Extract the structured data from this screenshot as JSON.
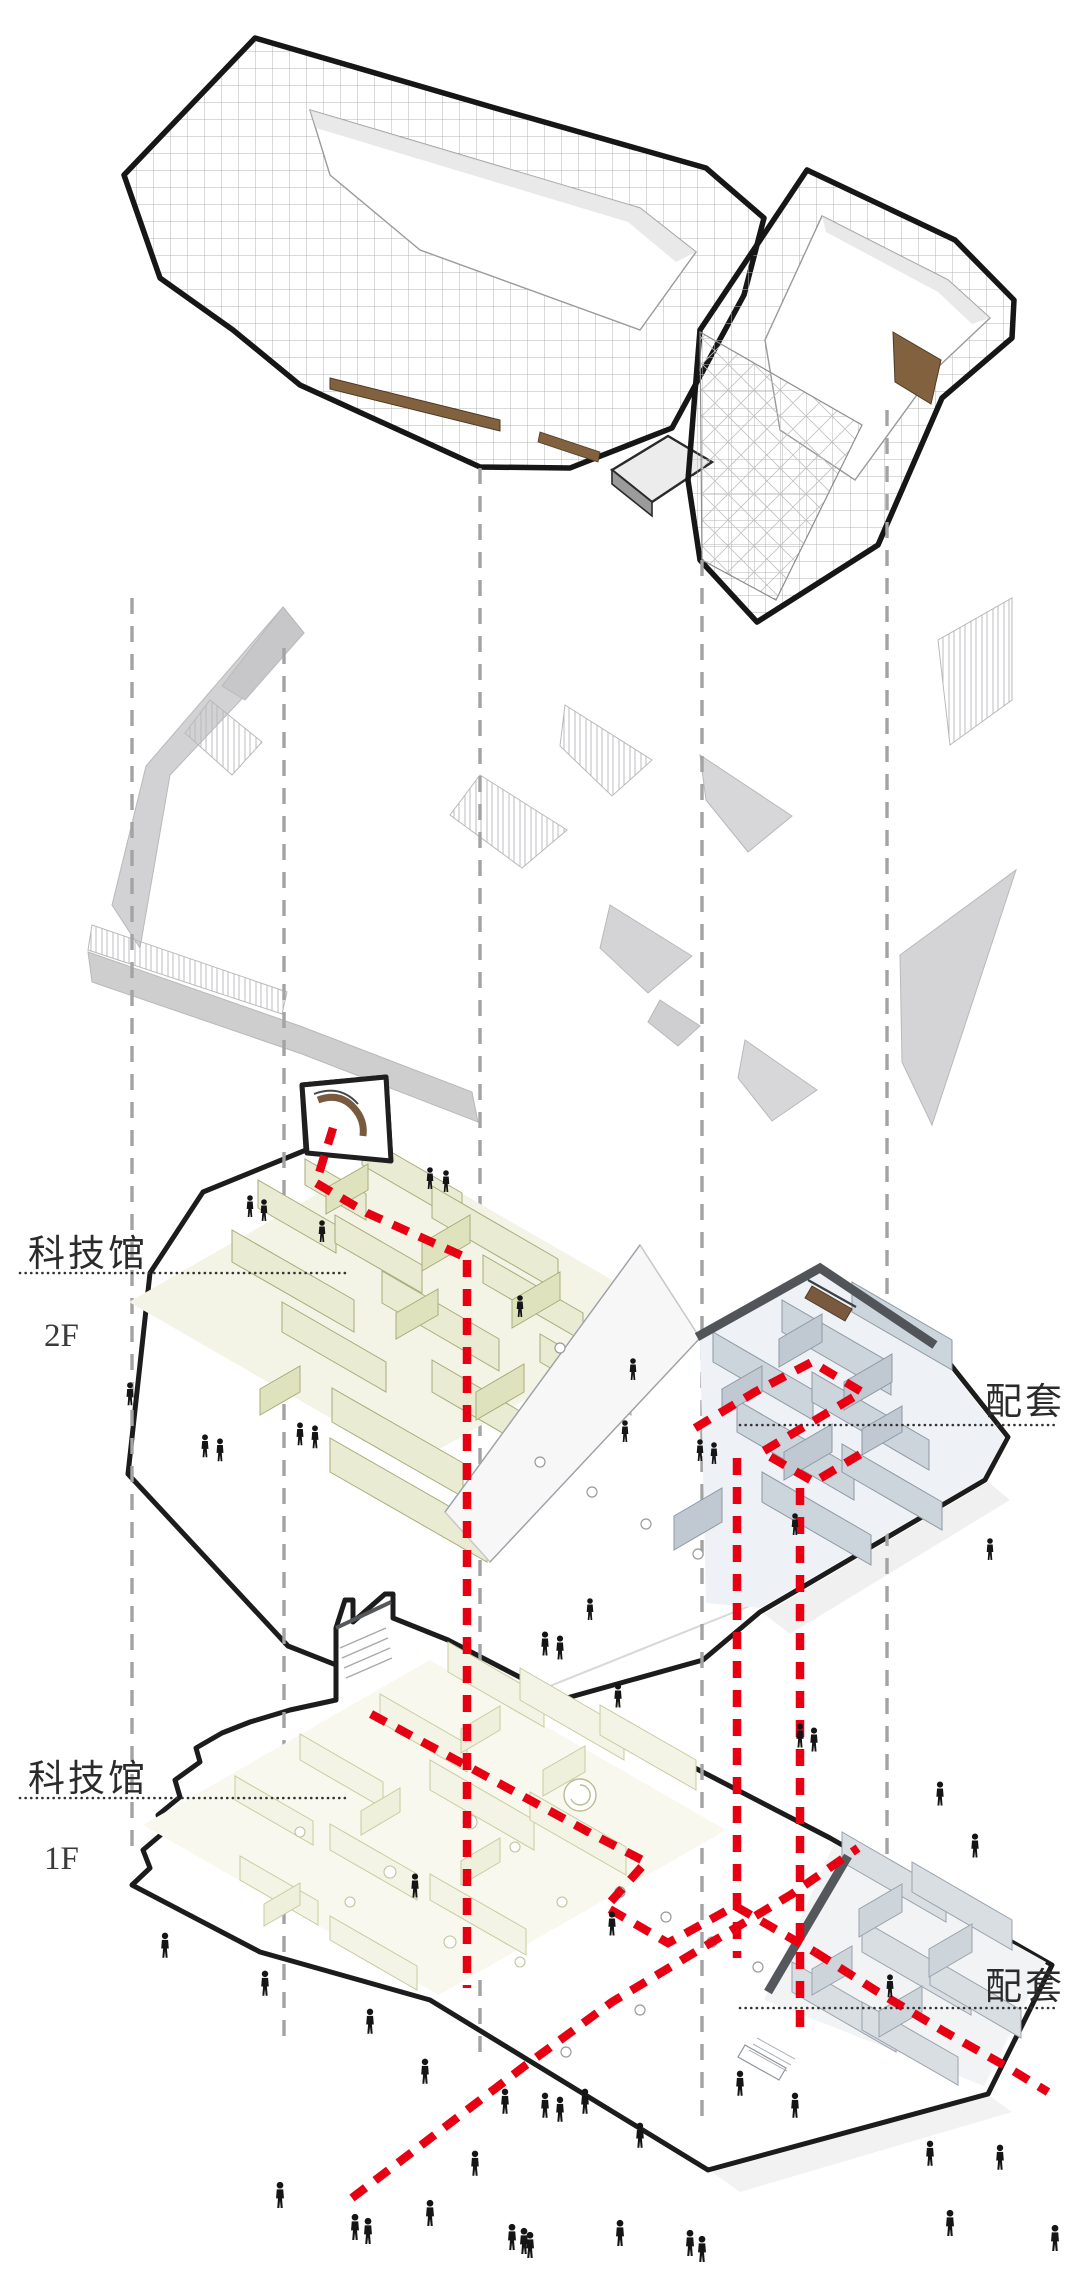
{
  "diagram": {
    "kind": "exploded-axonometric-building-diagram",
    "floors": [
      {
        "id": "2F",
        "name_label": "科技馆",
        "level_label": "2F",
        "annex_label": "配套"
      },
      {
        "id": "1F",
        "name_label": "科技馆",
        "level_label": "1F",
        "annex_label": "配套"
      }
    ],
    "legend_colors": {
      "circulation_route_red": "#e60012",
      "projection_line_gray": "#a3a3a3",
      "plate_outline_black": "#1c1c1c",
      "museum_zone_olive": "#e9ecd2",
      "annex_zone_blue_gray": "#ccd4dc",
      "wood_accent_brown": "#82613f"
    }
  }
}
